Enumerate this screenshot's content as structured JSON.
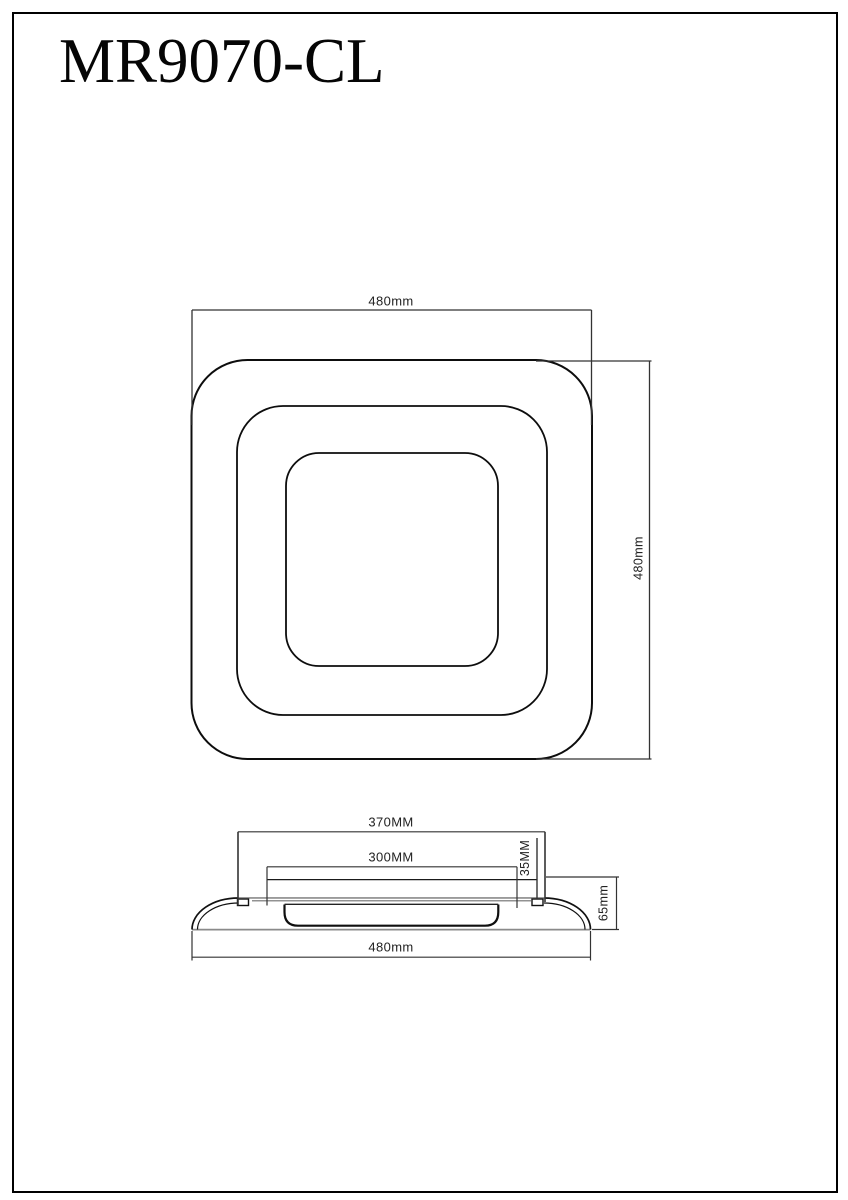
{
  "title": "MR9070-CL",
  "top_view": {
    "width_label": "480mm",
    "height_label": "480mm"
  },
  "side_view": {
    "flat_top_width_label": "370MM",
    "diffuser_width_label": "300MM",
    "housing_height_label": "35MM",
    "total_height_label": "65mm",
    "base_width_label": "480mm"
  },
  "colors": {
    "line": "#000000",
    "dim_line": "#333333",
    "plate_gray": "#9a9a9a",
    "background": "#ffffff"
  }
}
